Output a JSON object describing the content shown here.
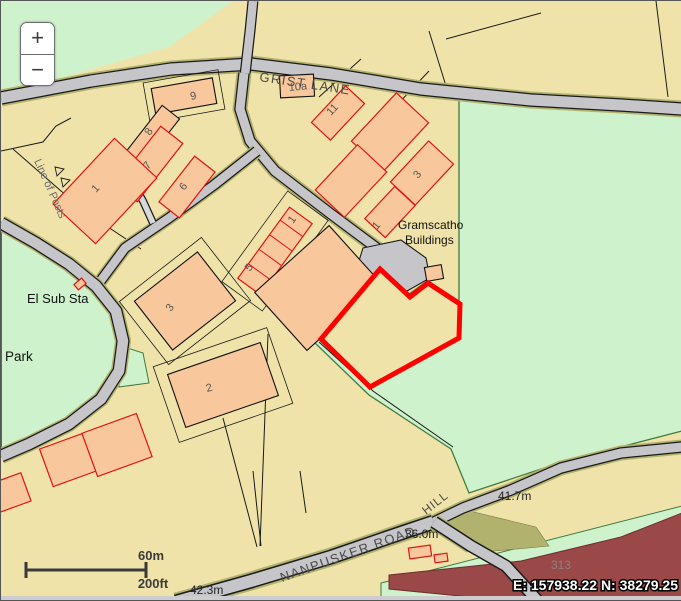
{
  "window": {
    "width": 681,
    "height": 599
  },
  "zoom_control": {
    "zoom_in": "+",
    "zoom_out": "−"
  },
  "scale_bar": {
    "metric": "60m",
    "imperial": "200ft"
  },
  "status": {
    "coordinates": "E: 157938.22 N: 38279.25",
    "faint_fragment": "313"
  },
  "road_labels": {
    "grist_lane": "GRIST LANE",
    "nanpusker_road": "NANPUSKER ROAD",
    "hill": "HILL"
  },
  "place_labels": {
    "el_sub_sta": "El Sub Sta",
    "park": "Park",
    "gramscatho_line1": "Gramscatho",
    "gramscatho_line2": "Buildings",
    "line_of_posts": "Line of Posts"
  },
  "elevations": {
    "hill_spot": "41.7m",
    "junction_spot": "36.0m",
    "southwest_spot": "42.3m"
  },
  "building_labels": {
    "b9": "9",
    "b10a": "10a",
    "b11": "11",
    "b8": "8",
    "b7": "7",
    "b6": "6",
    "b1_west": "1",
    "b3_east": "3",
    "b1_east": "1",
    "terrace_1": "1",
    "terrace_5": "5",
    "b3_west": "3",
    "b2": "2"
  },
  "colors": {
    "land": "#f0e3aa",
    "field_green": "#cdf2cc",
    "building_fill": "#f8c79b",
    "building_outline_red": "#e31212",
    "road_gray": "#c6c5c9",
    "verge_olive": "#b2b26f",
    "field_edge_green": "#3f7a3f",
    "b_road_maroon": "#9a4848",
    "selection_red": "#ff0000"
  }
}
